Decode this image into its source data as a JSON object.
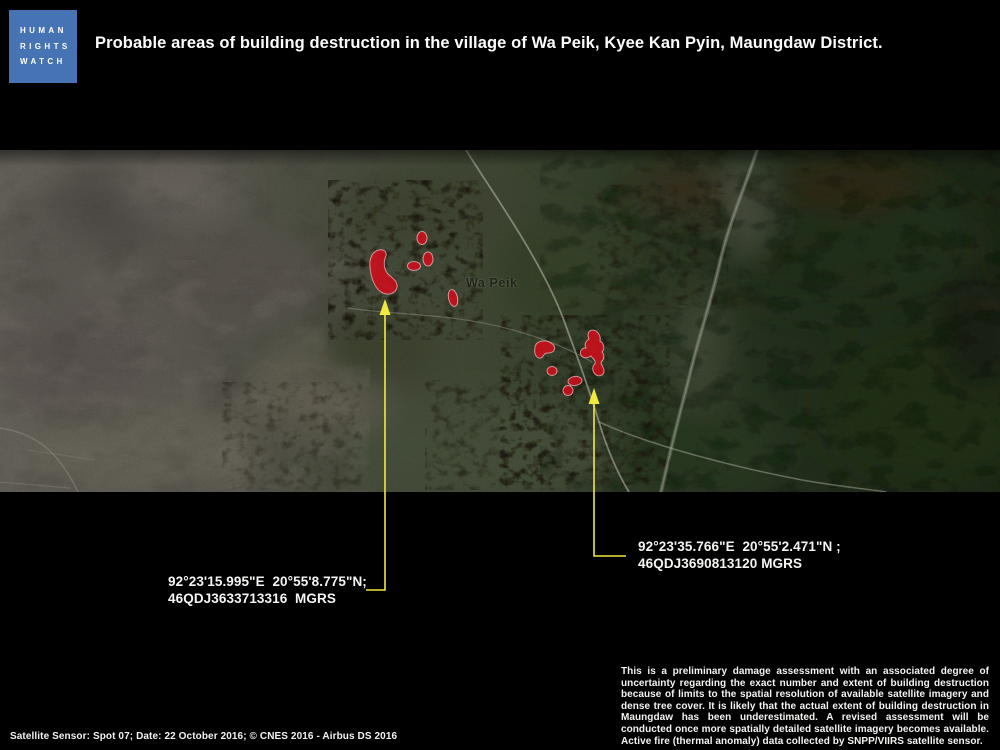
{
  "header": {
    "logo": {
      "lines": [
        "HUMAN",
        "RIGHTS",
        "WATCH"
      ]
    },
    "title": "Probable areas of building destruction in the village of Wa Peik, Kyee Kan Pyin, Maungdaw District."
  },
  "map": {
    "place_label": "Wa Peik",
    "callouts": [
      {
        "line1": "92°23'15.995\"E  20°55'8.775\"N;",
        "line2": "46QDJ3633713316  MGRS"
      },
      {
        "line1": "92°23'35.766\"E  20°55'2.471\"N ;",
        "line2": "46QDJ3690813120 MGRS"
      }
    ]
  },
  "footer": {
    "disclaimer": "This is a preliminary damage assessment with an associated degree of uncertainty regarding the exact number and extent of building destruction because of limits to the spatial resolution of available satellite imagery and dense tree cover. It is likely that the actual extent of building destruction in Maungdaw has been underestimated. A revised assessment will be conducted once more spatially detailed satellite imagery becomes available. Active fire (thermal anomaly) data collected by SNPP/VIIRS satellite sensor.",
    "credits": "Satellite Sensor: Spot 07; Date: 22 October 2016; © CNES 2016 - Airbus DS 2016"
  },
  "colors": {
    "logo_blue": "#4673b4",
    "accent_yellow": "#f2e93e",
    "destruction_red": "#e0101f",
    "background": "#000000"
  }
}
